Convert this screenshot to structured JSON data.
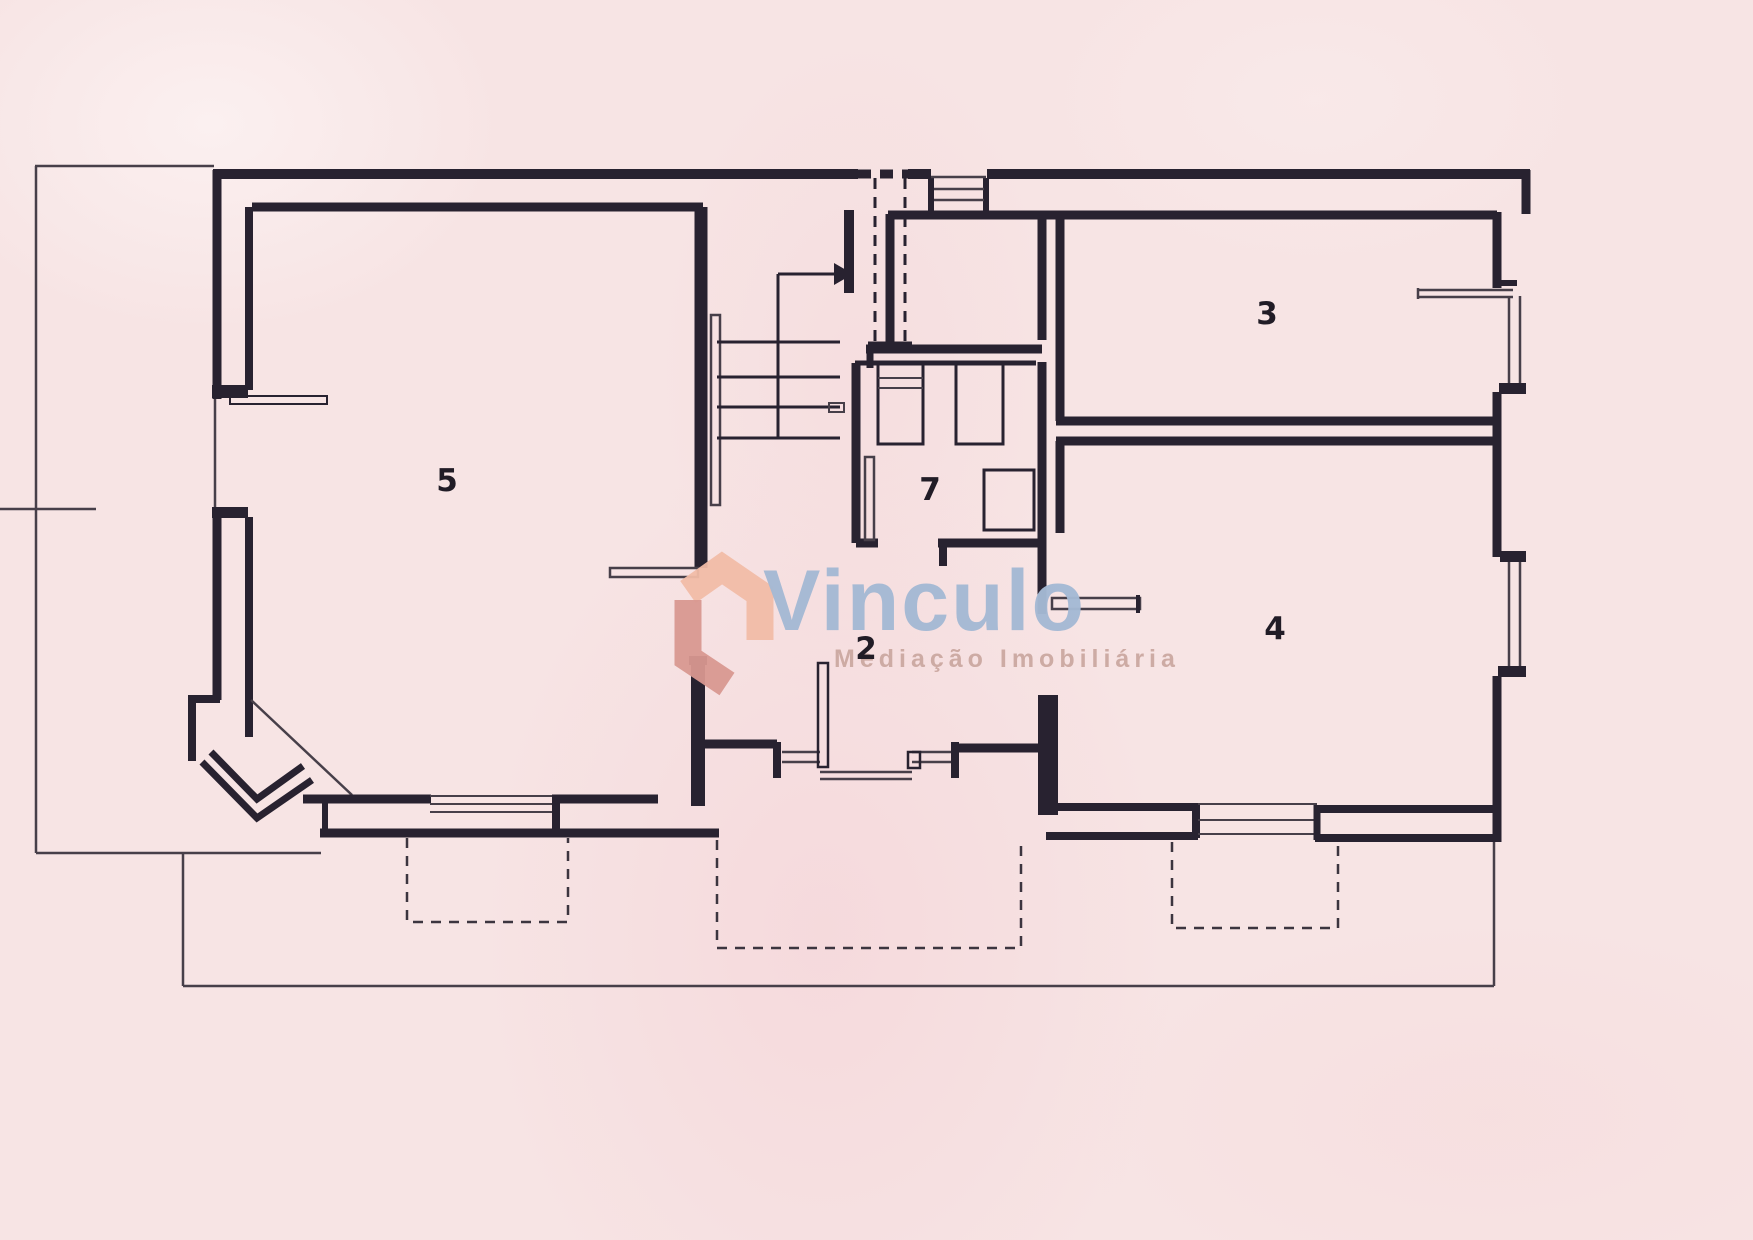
{
  "document": {
    "type": "floor-plan-scan",
    "background_color": "#f7e4e4",
    "ink_color": "#282230",
    "thin_line_color": "#473f49"
  },
  "watermark": {
    "brand": "Vinculo",
    "tagline": "Mediação Imobiliária",
    "brand_color": "#a4b9d4",
    "tagline_color": "#caa8a0",
    "house_icon": "vinculo-house-logo",
    "house_light_color": "#f1bca7",
    "house_dark_color": "#d89890"
  },
  "plan": {
    "rooms": [
      {
        "id": "room-5",
        "label": "5"
      },
      {
        "id": "room-7",
        "label": "7"
      },
      {
        "id": "room-3",
        "label": "3"
      },
      {
        "id": "room-4",
        "label": "4"
      },
      {
        "id": "room-2",
        "label": "2"
      }
    ],
    "features": [
      "site-boundary-thin-lines",
      "entrance-steps-top-center",
      "staircase-with-up-arrow",
      "bathroom-fixtures-room-7",
      "corner-bay-bottom-left",
      "windows-double-lines",
      "dashed-porch-outlines-bottom"
    ]
  }
}
